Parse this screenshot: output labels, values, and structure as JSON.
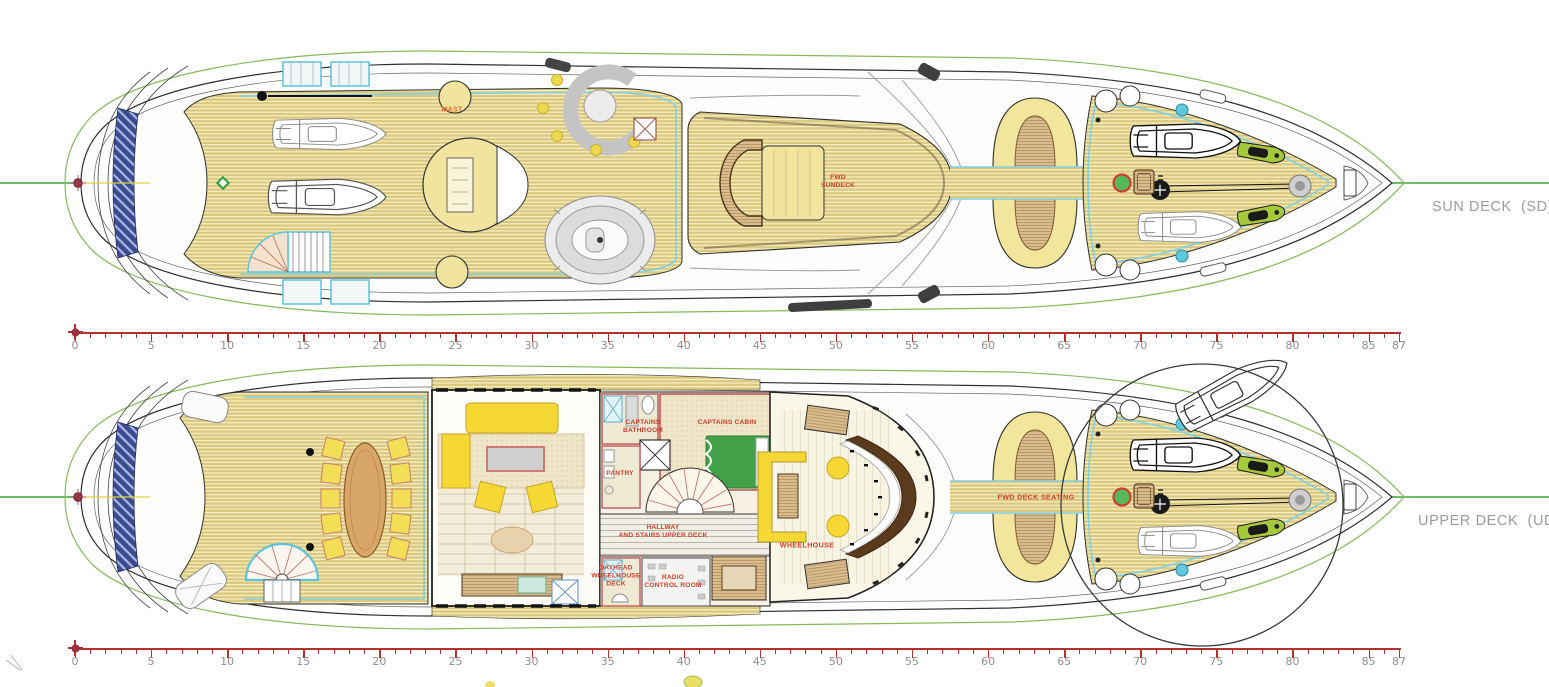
{
  "page": {
    "width": 1549,
    "height": 687,
    "background": "#ffffff"
  },
  "decks": [
    {
      "name": "Sun Deck",
      "side_label": "SUN DECK  (SD)",
      "labels": {
        "mast": "MAST",
        "fwd_sundeck": "FWD\nSUNDECK"
      }
    },
    {
      "name": "Upper Deck",
      "side_label": "UPPER DECK  (UD)",
      "labels": {
        "captains_bathroom": "CAPTAINS\nBATHROOM",
        "captains_cabin": "CAPTAINS CABIN",
        "pantry": "PANTRY",
        "hallway": "HALLWAY\nAND STAIRS UPPER DECK",
        "wheelhouse": "WHEELHOUSE",
        "dayhead": "DAYHEAD\nWHEELHOUSE\nDECK",
        "radio_control_room": "RADIO\nCONTROL ROOM",
        "fwd_deck_seating": "FWD DECK SEATING"
      }
    }
  ],
  "rulers": {
    "min": 0,
    "max": 87,
    "minor_step": 1,
    "major_step": 5,
    "labels": [
      0,
      5,
      10,
      15,
      20,
      25,
      30,
      35,
      40,
      45,
      50,
      55,
      60,
      65,
      70,
      75,
      80,
      85,
      87
    ]
  },
  "colors": {
    "centerline_green": "#3faa35",
    "envelope_green": "#86b95a",
    "ruler_red": "#b4322c",
    "ruler_text_grey": "#8f8f8f",
    "deck_label_grey": "#9c9c9c",
    "room_label_red": "#cf3f2b",
    "mast_label_orange": "#e07030",
    "teak_deck": "#dcc97c",
    "cyan_trim": "#7ed0e6",
    "stern_glass_blue": "#3b4b8f",
    "bed_green": "#41a148",
    "furniture_yellow": "#f6d835"
  }
}
